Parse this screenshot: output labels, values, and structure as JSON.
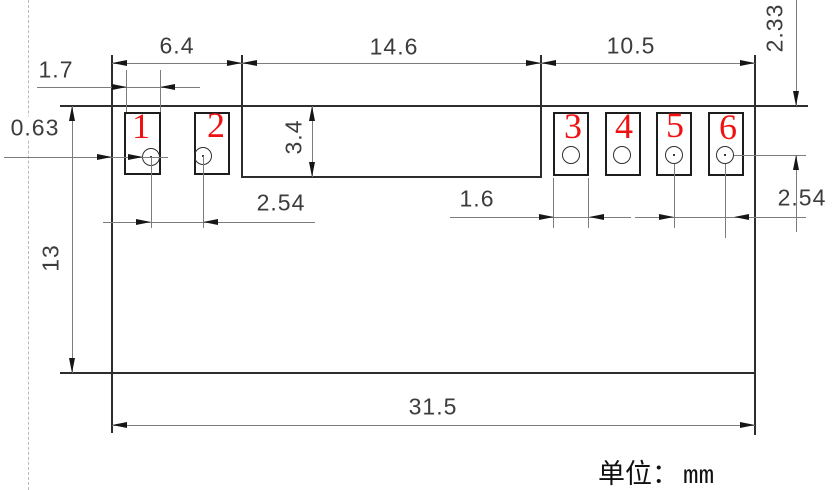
{
  "drawing": {
    "type": "pcb-footprint-dimension-drawing",
    "unit_note": {
      "label": "单位：",
      "value": "mm"
    },
    "pad_numbers": [
      "1",
      "2",
      "3",
      "4",
      "5",
      "6"
    ],
    "dimensions": {
      "left_section_width": "6.4",
      "center_section_width": "14.6",
      "right_section_width": "10.5",
      "left_pad_width": "1.7",
      "edge_to_pad_offset": "0.63",
      "center_recess_depth": "3.4",
      "left_hole_pitch": "2.54",
      "right_pad_width": "1.6",
      "right_hole_pitch": "2.54",
      "top_clearance": "2.33",
      "pin_row_offset": "2.54",
      "body_height": "13",
      "overall_width": "31.5"
    },
    "colors": {
      "background": "#ffffff",
      "outline": "#2d2d2d",
      "dimension_lines": "#7c7c7c",
      "arrowheads": "#161616",
      "dimension_text": "#3c3c3c",
      "pad_numbers": "#f01212",
      "dashed_guide": "#b8b8b8"
    }
  }
}
